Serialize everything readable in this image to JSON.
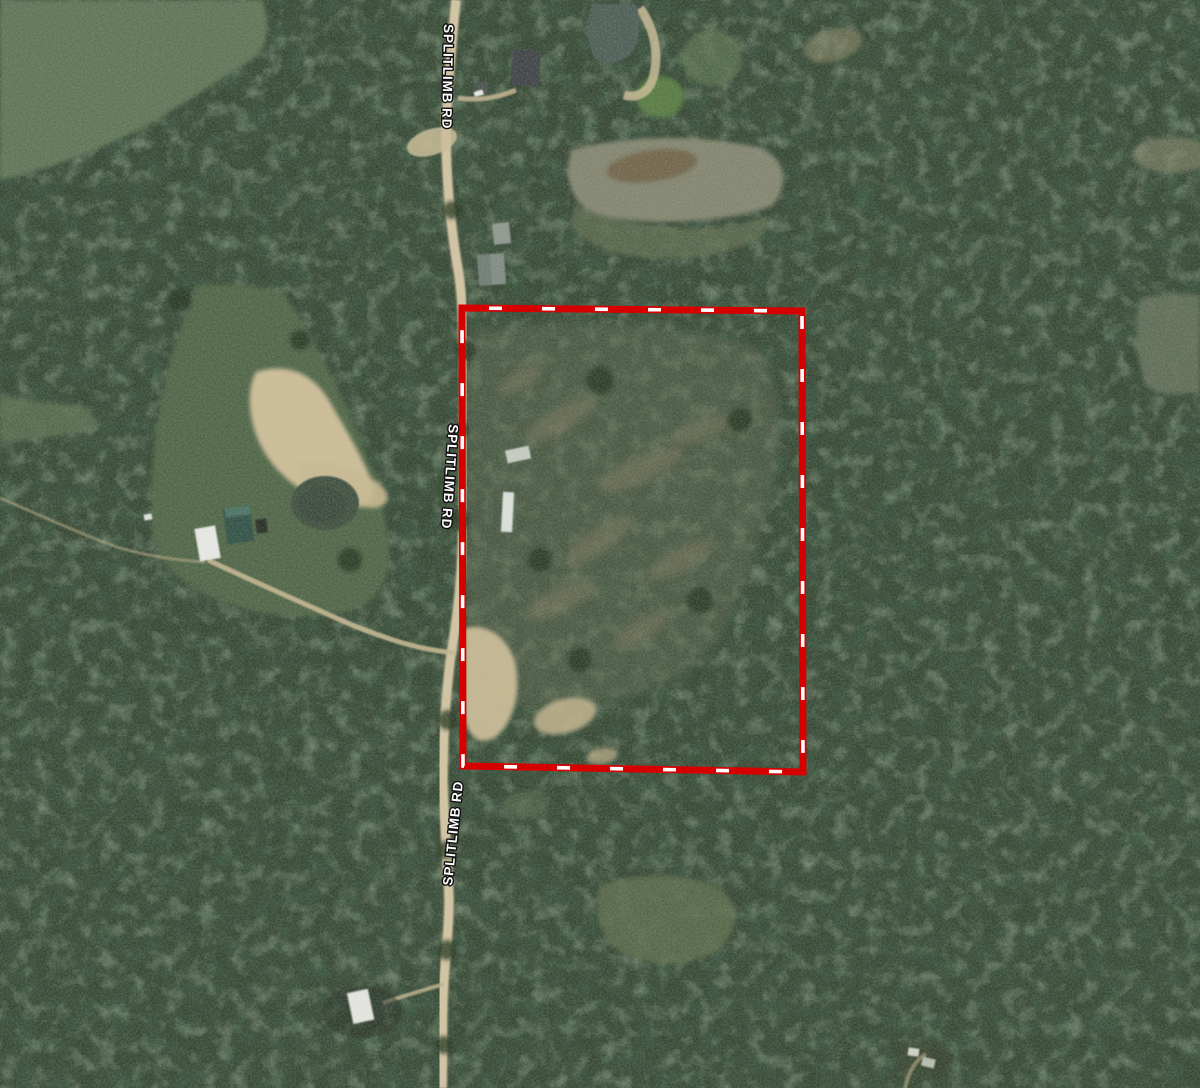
{
  "map": {
    "imagery": "satellite",
    "road": {
      "label": "SPLITLIMB RD"
    },
    "boundary": {
      "color": "#d60000",
      "dash_color": "#ffffff"
    }
  }
}
